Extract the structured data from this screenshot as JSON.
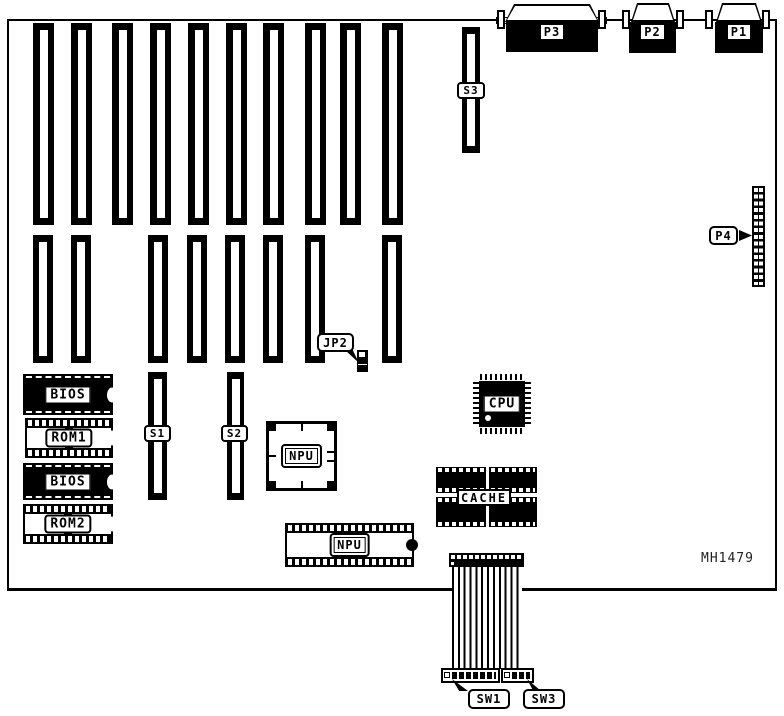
{
  "board": {
    "part_number": "MH1479"
  },
  "colors": {
    "foreground": "#000000",
    "background": "#ffffff"
  },
  "expansion_slots": {
    "row1_count": 10,
    "row2_count": 8
  },
  "connectors": {
    "p1": {
      "label": "P1"
    },
    "p2": {
      "label": "P2"
    },
    "p3": {
      "label": "P3"
    },
    "p4": {
      "label": "P4"
    }
  },
  "slots": {
    "s1": {
      "label": "S1"
    },
    "s2": {
      "label": "S2"
    },
    "s3": {
      "label": "S3"
    }
  },
  "jumpers": {
    "jp2": {
      "label": "JP2"
    }
  },
  "switches": {
    "sw1": {
      "label": "SW1"
    },
    "sw3": {
      "label": "SW3"
    }
  },
  "chips": {
    "bios1": {
      "label": "BIOS"
    },
    "rom1": {
      "label": "ROM1"
    },
    "bios2": {
      "label": "BIOS"
    },
    "rom2": {
      "label": "ROM2"
    },
    "npu_socket": {
      "label": "NPU"
    },
    "npu_dip": {
      "label": "NPU"
    },
    "cpu": {
      "label": "CPU"
    },
    "cache": {
      "label": "CACHE"
    }
  }
}
